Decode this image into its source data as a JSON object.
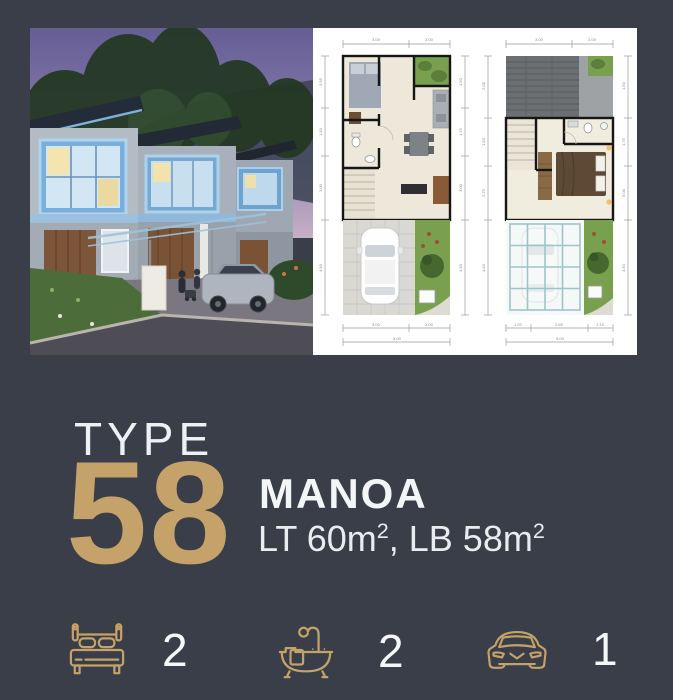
{
  "theme": {
    "background": "#393E48",
    "accent_gold": "#C5A269",
    "text_white": "#F4F5F7"
  },
  "hero": {
    "photo": {
      "description": "two-storey house exterior render at dusk"
    },
    "plans": {
      "plan1": {
        "name": "first-floor-plan",
        "top": [
          "3.00",
          "2.00"
        ],
        "left": [
          "1.95",
          "1.50",
          "3.00",
          "4.50"
        ],
        "right": [
          "1.50",
          "1.75",
          "3.00",
          "4.50"
        ],
        "bottom": [
          "3.00",
          "2.00"
        ],
        "total": "5.00"
      },
      "plan2": {
        "name": "second-floor-plan",
        "top": [
          "3.00",
          "2.00"
        ],
        "left": [
          "2.05",
          "1.50",
          "2.70",
          "4.50"
        ],
        "right": [
          "1.50",
          "1.75",
          "3.00",
          "4.50"
        ],
        "bottom": [
          "1.20",
          "2.65",
          "1.15"
        ],
        "total": "5.00"
      }
    }
  },
  "info": {
    "type_label": "TYPE",
    "type_number": "58",
    "name": "MANOA",
    "area": {
      "lt": "LT 60m",
      "lt_sup": "2",
      "sep": ", ",
      "lb": "LB 58m",
      "lb_sup": "2"
    }
  },
  "features": [
    {
      "icon": "bed-icon",
      "count": "2"
    },
    {
      "icon": "bath-icon",
      "count": "2"
    },
    {
      "icon": "car-icon",
      "count": "1"
    }
  ]
}
